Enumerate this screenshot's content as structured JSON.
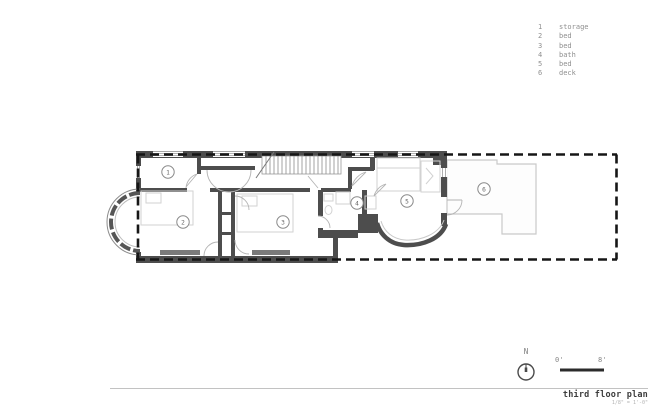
{
  "legend": {
    "items": [
      {
        "number": "1",
        "label": "storage"
      },
      {
        "number": "2",
        "label": "bed"
      },
      {
        "number": "3",
        "label": "bed"
      },
      {
        "number": "4",
        "label": "bath"
      },
      {
        "number": "5",
        "label": "bed"
      },
      {
        "number": "6",
        "label": "deck"
      }
    ]
  },
  "plan": {
    "room_markers": [
      {
        "number": "1",
        "name": "storage"
      },
      {
        "number": "2",
        "name": "bed"
      },
      {
        "number": "3",
        "name": "bed"
      },
      {
        "number": "4",
        "name": "bath"
      },
      {
        "number": "5",
        "name": "bed"
      },
      {
        "number": "6",
        "name": "deck"
      }
    ]
  },
  "compass": {
    "north_label": "N"
  },
  "scale_bar": {
    "zero_label": "0'",
    "eight_label": "8'"
  },
  "title_block": {
    "title": "third floor plan",
    "scale_note": "1/8\" = 1'-0\""
  },
  "colors": {
    "wall": "#4d4d4d",
    "property_line": "#161616",
    "light_outline": "#c9c9c9",
    "door_swing": "#b4b4b4",
    "legend_text": "#8f8f8f",
    "title_text": "#3d3d3d",
    "scale_bar": "#2b2b2b"
  }
}
